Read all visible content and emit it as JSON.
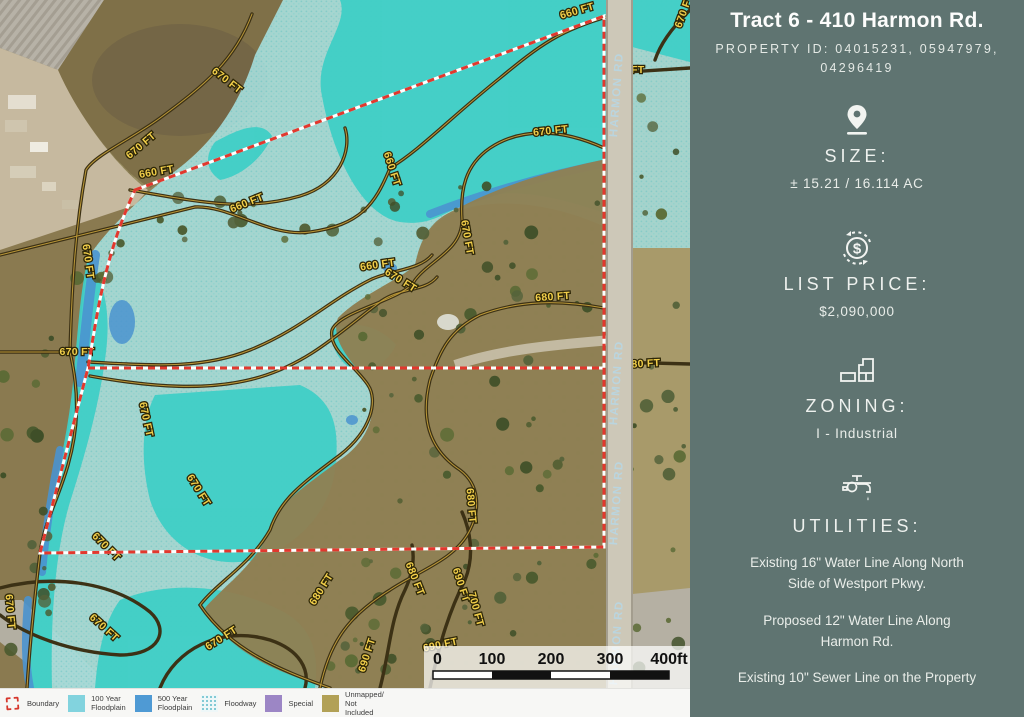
{
  "sidebar": {
    "title": "Tract 6 - 410 Harmon Rd.",
    "property_id": "PROPERTY ID: 04015231, 05947979,\n04296419",
    "size_label": "SIZE:",
    "size_value": "± 15.21 / 16.114 AC",
    "price_label": "LIST PRICE:",
    "price_value": "$2,090,000",
    "zoning_label": "ZONING:",
    "zoning_value": "I - Industrial",
    "utilities_label": "UTILITIES:",
    "utility_1": "Existing 16\" Water Line Along North\nSide of Westport Pkwy.",
    "utility_2": "Proposed 12\" Water Line Along\nHarmon Rd.",
    "utility_3": "Existing 10\" Sewer Line on the Property"
  },
  "legend": {
    "items": [
      {
        "type": "boundary",
        "color": "#d6372c",
        "label": "Boundary"
      },
      {
        "type": "swatch",
        "color": "#82d3de",
        "label": "100 Year\nFloodplain"
      },
      {
        "type": "swatch",
        "color": "#4f9ad4",
        "label": "500 Year\nFloodplain"
      },
      {
        "type": "dots",
        "color": "#cfe9ec",
        "label": "Floodway"
      },
      {
        "type": "swatch",
        "color": "#9c86c5",
        "label": "Special"
      },
      {
        "type": "swatch",
        "color": "#b2a156",
        "label": "Unmapped/ Not\nIncluded"
      }
    ]
  },
  "map": {
    "road_label": "HARMON RD",
    "road_label_ys": [
      95,
      383,
      503,
      643
    ],
    "contour_labels": [
      {
        "t": "660 FT",
        "x": 578,
        "y": 14,
        "r": -16
      },
      {
        "t": "670 FT",
        "x": 687,
        "y": 12,
        "r": -70
      },
      {
        "t": "660 FT",
        "x": 627,
        "y": 73,
        "r": 0
      },
      {
        "t": "670 FT",
        "x": 551,
        "y": 134,
        "r": -6
      },
      {
        "t": "670 FT",
        "x": 225,
        "y": 83,
        "r": 38
      },
      {
        "t": "670 FT",
        "x": 143,
        "y": 148,
        "r": -40
      },
      {
        "t": "660 FT",
        "x": 157,
        "y": 175,
        "r": -10
      },
      {
        "t": "660 FT",
        "x": 248,
        "y": 206,
        "r": -22
      },
      {
        "t": "670 FT",
        "x": 85,
        "y": 262,
        "r": 82
      },
      {
        "t": "660 FT",
        "x": 389,
        "y": 170,
        "r": 72
      },
      {
        "t": "660 FT",
        "x": 378,
        "y": 268,
        "r": -8
      },
      {
        "t": "670 FT",
        "x": 399,
        "y": 283,
        "r": 32
      },
      {
        "t": "680 FT",
        "x": 553,
        "y": 300,
        "r": -4
      },
      {
        "t": "670 FT",
        "x": 464,
        "y": 238,
        "r": 80
      },
      {
        "t": "670 FT",
        "x": 77,
        "y": 355,
        "r": 0
      },
      {
        "t": "670 FT",
        "x": 143,
        "y": 420,
        "r": 78
      },
      {
        "t": "670 FT",
        "x": 196,
        "y": 492,
        "r": 58
      },
      {
        "t": "670 FT",
        "x": 104,
        "y": 549,
        "r": 45
      },
      {
        "t": "670 FT",
        "x": 102,
        "y": 630,
        "r": 42
      },
      {
        "t": "670 FT",
        "x": 7,
        "y": 612,
        "r": 85
      },
      {
        "t": "670 FT",
        "x": 223,
        "y": 641,
        "r": -32
      },
      {
        "t": "680 FT",
        "x": 324,
        "y": 591,
        "r": -58
      },
      {
        "t": "690 FT",
        "x": 370,
        "y": 656,
        "r": -72
      },
      {
        "t": "680 FT",
        "x": 412,
        "y": 580,
        "r": 68
      },
      {
        "t": "690 FT",
        "x": 458,
        "y": 586,
        "r": 72
      },
      {
        "t": "700 FT",
        "x": 473,
        "y": 610,
        "r": 75
      },
      {
        "t": "680 FT",
        "x": 468,
        "y": 506,
        "r": 85
      },
      {
        "t": "680 FT",
        "x": 643,
        "y": 367,
        "r": -3
      },
      {
        "t": "690 FT",
        "x": 441,
        "y": 648,
        "r": -12
      }
    ],
    "scale_bar": {
      "ticks": [
        "0",
        "100",
        "200",
        "300",
        "400ft"
      ]
    }
  },
  "colors": {
    "sidebar_bg": "#5f7471",
    "boundary_red": "#e2382e",
    "floodway_bright": "#3fcfc6",
    "floodplain_pale": "#a7dcd8",
    "floodplain_500": "#4a93cf"
  }
}
